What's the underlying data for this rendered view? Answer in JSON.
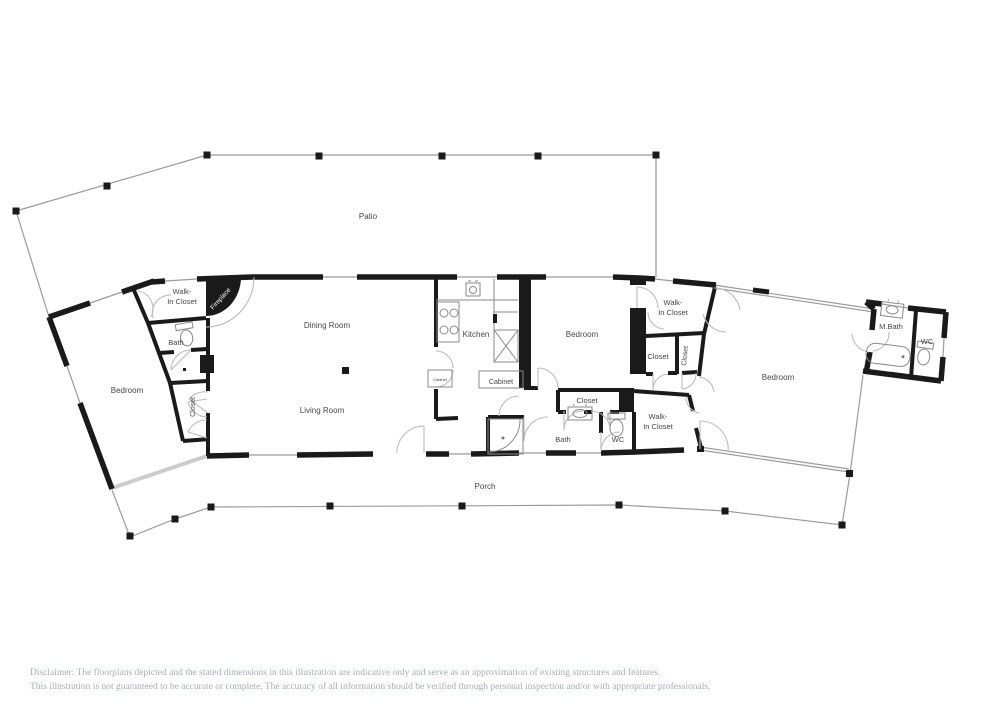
{
  "floorplan": {
    "wall_color": "#1a1a1a",
    "thin_line_color": "#9b9b9b",
    "door_arc_color": "#bcbcbc",
    "label_color": "#474747",
    "icons": {
      "toilet-icon": "ellipse bowl + rectangular tank",
      "sink-icon": "rect vanity with oval basin",
      "bathtub-icon": "rounded rectangle tub",
      "corner-bathtub-icon": "quarter-round corner tub",
      "stove-icon": "four burner circles",
      "pantry-cabinet-icon": "rect with X front",
      "fireplace-icon": "black quarter-round with hearth arc",
      "post-icon": "small solid black square",
      "door-icon": "quarter-circle swing arc"
    },
    "labels": [
      {
        "id": "patio",
        "text": "Patio",
        "x": 368,
        "y": 219,
        "size": 8
      },
      {
        "id": "walk-in-closet-left",
        "text": [
          "Walk-",
          "In Closet"
        ],
        "x": 182,
        "y": 294,
        "size": 7.5
      },
      {
        "id": "bath-left",
        "text": "Bath",
        "x": 176,
        "y": 345,
        "size": 7.5
      },
      {
        "id": "bedroom-left",
        "text": "Bedroom",
        "x": 127,
        "y": 393,
        "size": 8
      },
      {
        "id": "closet-left",
        "text": "Closet",
        "x": 195,
        "y": 407,
        "size": 7,
        "rotate": -90
      },
      {
        "id": "fireplace",
        "text": "Fireplace",
        "x": 222,
        "y": 300,
        "size": 6.5,
        "rotate": -48,
        "color": "#ffffff"
      },
      {
        "id": "dining-room",
        "text": "Dining Room",
        "x": 327,
        "y": 328,
        "size": 8
      },
      {
        "id": "living-room",
        "text": "Living Room",
        "x": 322,
        "y": 413,
        "size": 8
      },
      {
        "id": "kitchen",
        "text": "Kitchen",
        "x": 476,
        "y": 337,
        "size": 8
      },
      {
        "id": "cabinet-small",
        "text": "Cabinet",
        "x": 440,
        "y": 381,
        "size": 4
      },
      {
        "id": "cabinet",
        "text": "Cabinet",
        "x": 501,
        "y": 384,
        "size": 7
      },
      {
        "id": "bedroom-middle",
        "text": "Bedroom",
        "x": 582,
        "y": 337,
        "size": 8
      },
      {
        "id": "closet-middle",
        "text": "Closet",
        "x": 587,
        "y": 403,
        "size": 7.5
      },
      {
        "id": "bath-middle",
        "text": "Bath",
        "x": 563,
        "y": 442,
        "size": 7.5
      },
      {
        "id": "wc-middle",
        "text": "WC",
        "x": 618,
        "y": 442,
        "size": 7.5
      },
      {
        "id": "walk-in-closet-right-top",
        "text": [
          "Walk-",
          "In Closet"
        ],
        "x": 673,
        "y": 305,
        "size": 7.5
      },
      {
        "id": "closet-right",
        "text": "Closet",
        "x": 658,
        "y": 359,
        "size": 7.5
      },
      {
        "id": "closet-right-narrow",
        "text": "Closet",
        "x": 687,
        "y": 356,
        "size": 7,
        "rotate": -84
      },
      {
        "id": "walk-in-closet-right-bottom",
        "text": [
          "Walk-",
          "In Closet"
        ],
        "x": 658,
        "y": 419,
        "size": 7.5
      },
      {
        "id": "bedroom-right",
        "text": "Bedroom",
        "x": 778,
        "y": 380,
        "size": 8
      },
      {
        "id": "m-bath",
        "text": "M.Bath",
        "x": 891,
        "y": 329,
        "size": 7.5
      },
      {
        "id": "wc-right",
        "text": "WC",
        "x": 927,
        "y": 344,
        "size": 7.5
      },
      {
        "id": "porch",
        "text": "Porch",
        "x": 485,
        "y": 489,
        "size": 8
      }
    ]
  },
  "disclaimer": {
    "line1": "Disclaimer: The floorplans depicted and the stated dimensions in this illustration are indicative only and serve as an approximation of existing structures and features.",
    "line2": "This illustration is not guaranteed to be accurate or complete. The accuracy of all information should be verified through personal inspection and/or with appropriate professionals."
  }
}
